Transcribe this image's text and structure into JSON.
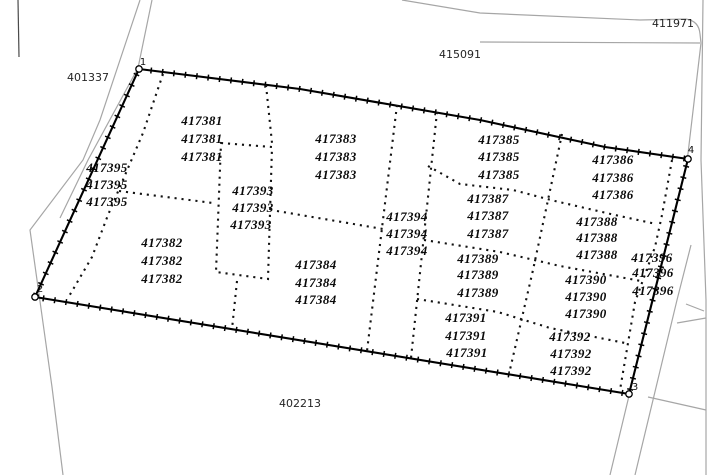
{
  "figure": {
    "type": "cadastral-parcel-map",
    "background_color": "#ffffff",
    "boundary_color": "#000000",
    "division_line_color": "#121212",
    "road_color": "#a6a6a6"
  },
  "map": {
    "corner_points": [
      {
        "label": "1",
        "x": 139,
        "y": 69,
        "label_x": 143,
        "label_y": 65
      },
      {
        "label": "2",
        "x": 35,
        "y": 297,
        "label_x": 40,
        "label_y": 292
      },
      {
        "label": "3",
        "x": 629,
        "y": 394,
        "label_x": 635,
        "label_y": 390
      },
      {
        "label": "4",
        "x": 688,
        "y": 159,
        "label_x": 691,
        "label_y": 153
      }
    ],
    "adjacent_labels": [
      {
        "text": "401337",
        "x": 88,
        "y": 81
      },
      {
        "text": "415091",
        "x": 460,
        "y": 58
      },
      {
        "text": "411971",
        "x": 673,
        "y": 27
      },
      {
        "text": "402213",
        "x": 300,
        "y": 407
      }
    ],
    "parcels": [
      {
        "id": "417381",
        "label_positions": [
          [
            202,
            125
          ],
          [
            202,
            143
          ],
          [
            202,
            161
          ]
        ]
      },
      {
        "id": "417382",
        "label_positions": [
          [
            162,
            247
          ],
          [
            162,
            265
          ],
          [
            162,
            283
          ]
        ]
      },
      {
        "id": "417383",
        "label_positions": [
          [
            336,
            143
          ],
          [
            336,
            161
          ],
          [
            336,
            179
          ]
        ]
      },
      {
        "id": "417384",
        "label_positions": [
          [
            316,
            269
          ],
          [
            316,
            287
          ],
          [
            316,
            304
          ]
        ]
      },
      {
        "id": "417385",
        "label_positions": [
          [
            499,
            144
          ],
          [
            499,
            161
          ],
          [
            499,
            179
          ]
        ]
      },
      {
        "id": "417386",
        "label_positions": [
          [
            613,
            164
          ],
          [
            613,
            182
          ],
          [
            613,
            199
          ]
        ]
      },
      {
        "id": "417387",
        "label_positions": [
          [
            488,
            203
          ],
          [
            488,
            220
          ],
          [
            488,
            238
          ]
        ]
      },
      {
        "id": "417388",
        "label_positions": [
          [
            597,
            226
          ],
          [
            597,
            242
          ],
          [
            597,
            259
          ]
        ]
      },
      {
        "id": "417389",
        "label_positions": [
          [
            478,
            263
          ],
          [
            478,
            279
          ],
          [
            478,
            297
          ]
        ]
      },
      {
        "id": "417390",
        "label_positions": [
          [
            586,
            284
          ],
          [
            586,
            301
          ],
          [
            586,
            318
          ]
        ]
      },
      {
        "id": "417391",
        "label_positions": [
          [
            466,
            322
          ],
          [
            466,
            340
          ],
          [
            467,
            357
          ]
        ]
      },
      {
        "id": "417392",
        "label_positions": [
          [
            570,
            341
          ],
          [
            571,
            358
          ],
          [
            571,
            375
          ]
        ]
      },
      {
        "id": "417393",
        "label_positions": [
          [
            253,
            195
          ],
          [
            253,
            212
          ],
          [
            251,
            229
          ]
        ]
      },
      {
        "id": "417394",
        "label_positions": [
          [
            407,
            221
          ],
          [
            407,
            238
          ],
          [
            407,
            255
          ]
        ]
      },
      {
        "id": "417395",
        "label_positions": [
          [
            107,
            172
          ],
          [
            107,
            189
          ],
          [
            107,
            206
          ]
        ]
      },
      {
        "id": "417396",
        "label_positions": [
          [
            652,
            262
          ],
          [
            653,
            277
          ],
          [
            653,
            295
          ]
        ]
      }
    ]
  }
}
